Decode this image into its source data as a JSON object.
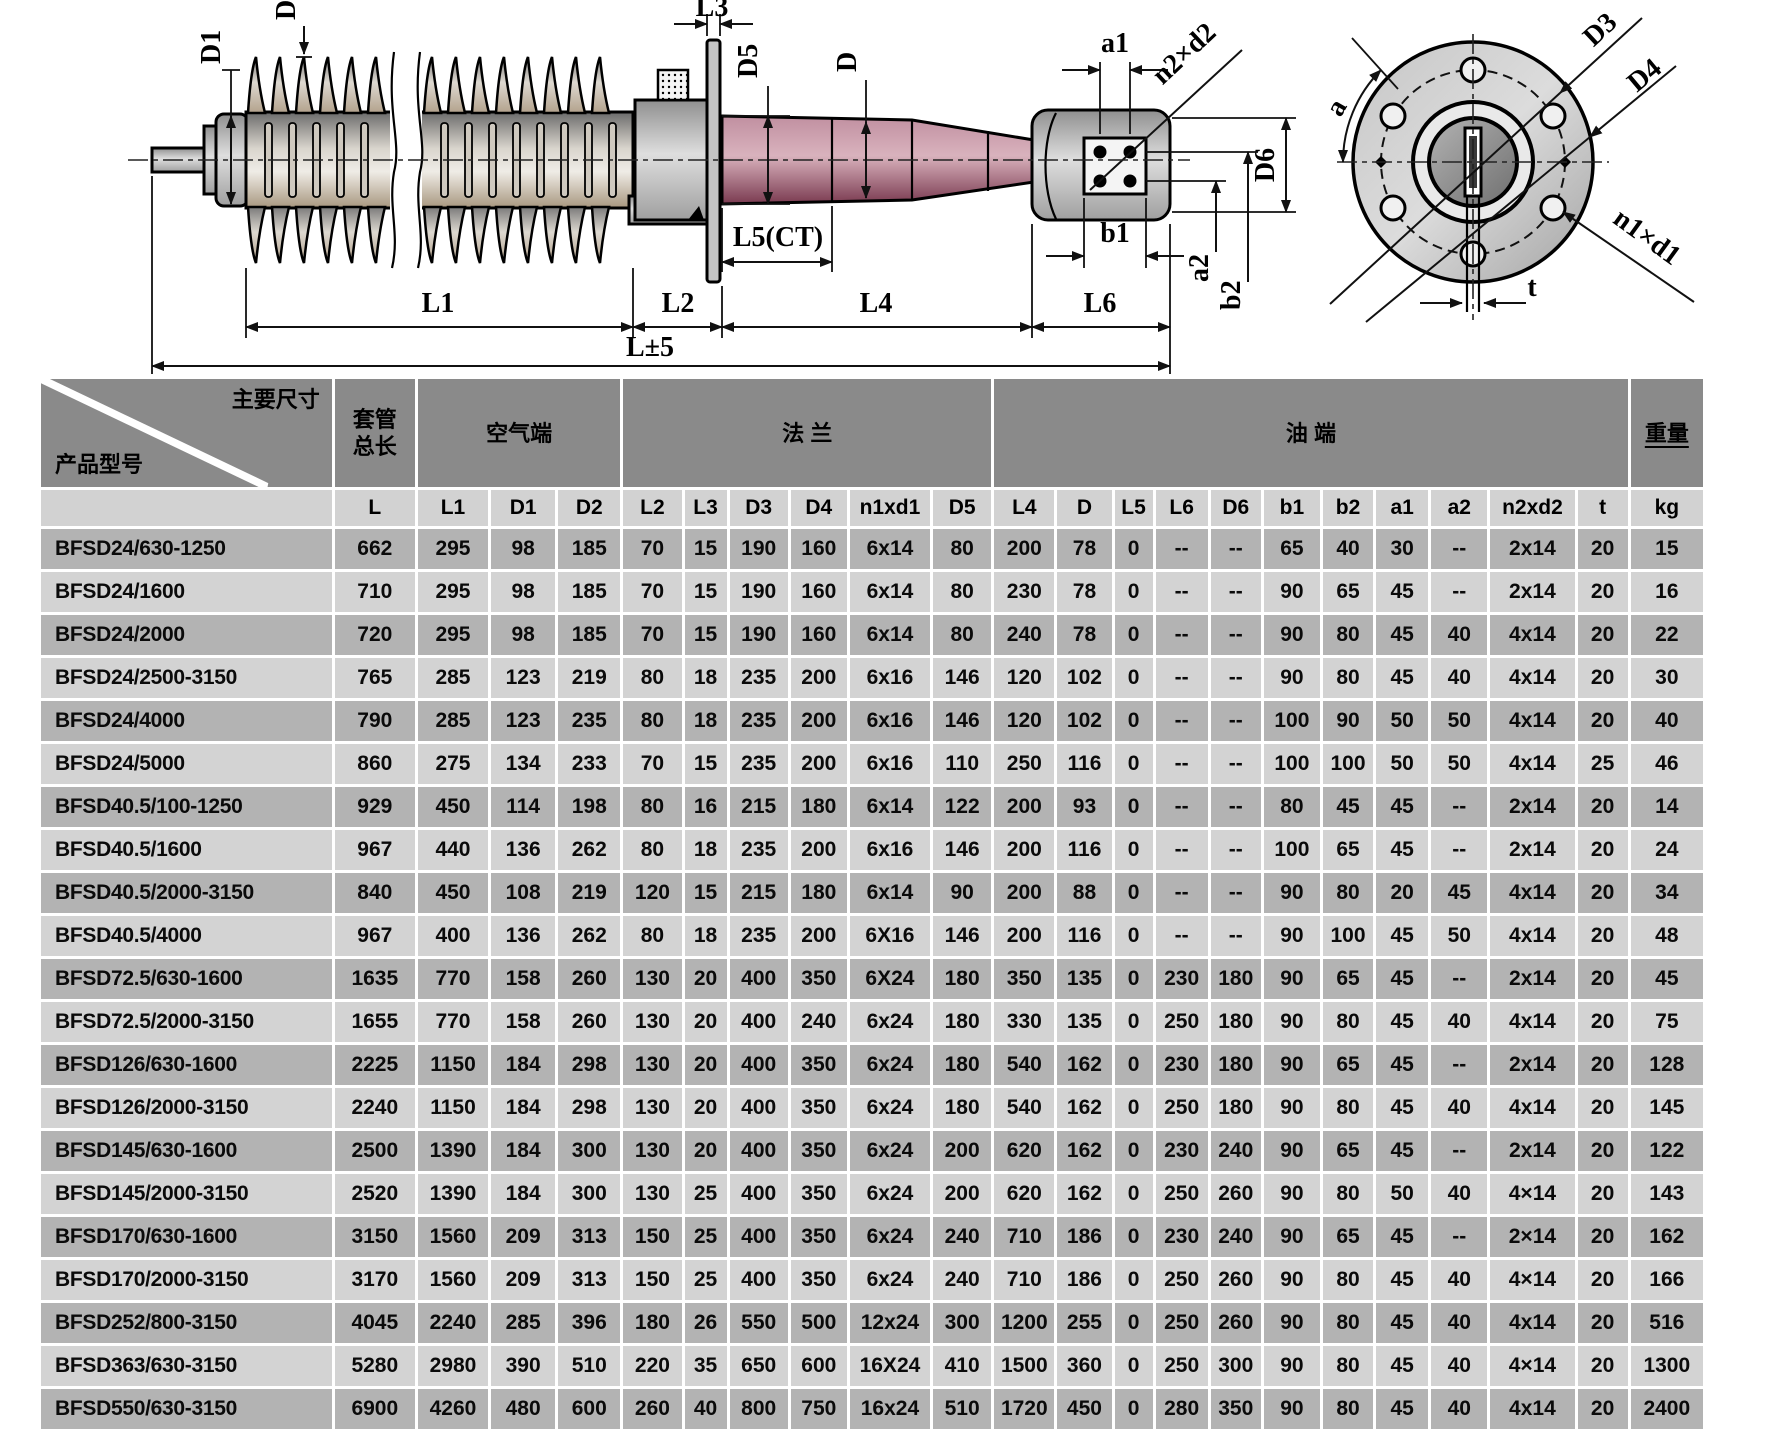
{
  "colors": {
    "header_bg": "#8a8a8a",
    "subheader_bg": "#d2d2d2",
    "row_dark": "#b3b3b3",
    "row_light": "#d3d3d3",
    "oil_body_pink": "#b5788c",
    "porcelain_gray": "#c9c2b6",
    "steel_gray": "#bfbfbf"
  },
  "drawing": {
    "labels": {
      "d1": "D1",
      "d2": "D2",
      "l3": "L3",
      "d5": "D5",
      "d": "D",
      "a1": "a1",
      "n2xd2": "n2×d2",
      "b1": "b1",
      "a2": "a2",
      "b2": "b2",
      "d6": "D6",
      "l1": "L1",
      "l2": "L2",
      "l4": "L4",
      "l5": "L5(CT)",
      "l6": "L6",
      "l_total": "L±5",
      "d3": "D3",
      "d4": "D4",
      "a": "a",
      "n1xd1": "n1×d1",
      "t": "t"
    }
  },
  "table": {
    "corner": {
      "top_label": "主要尺寸",
      "bottom_label": "产品型号"
    },
    "groups": {
      "total_length": "套管\n总长",
      "air_end": "空气端",
      "flange": "法 兰",
      "oil_end": "油 端",
      "weight": "重量"
    },
    "columns": [
      "L",
      "L1",
      "D1",
      "D2",
      "L2",
      "L3",
      "D3",
      "D4",
      "n1xd1",
      "D5",
      "L4",
      "D",
      "L5",
      "L6",
      "D6",
      "b1",
      "b2",
      "a1",
      "a2",
      "n2xd2",
      "t",
      "kg"
    ],
    "rows": [
      {
        "model": "BFSD24/630-1250",
        "values": [
          "662",
          "295",
          "98",
          "185",
          "70",
          "15",
          "190",
          "160",
          "6x14",
          "80",
          "200",
          "78",
          "0",
          "--",
          "--",
          "65",
          "40",
          "30",
          "--",
          "2x14",
          "20",
          "15"
        ]
      },
      {
        "model": "BFSD24/1600",
        "values": [
          "710",
          "295",
          "98",
          "185",
          "70",
          "15",
          "190",
          "160",
          "6x14",
          "80",
          "230",
          "78",
          "0",
          "--",
          "--",
          "90",
          "65",
          "45",
          "--",
          "2x14",
          "20",
          "16"
        ]
      },
      {
        "model": "BFSD24/2000",
        "values": [
          "720",
          "295",
          "98",
          "185",
          "70",
          "15",
          "190",
          "160",
          "6x14",
          "80",
          "240",
          "78",
          "0",
          "--",
          "--",
          "90",
          "80",
          "45",
          "40",
          "4x14",
          "20",
          "22"
        ]
      },
      {
        "model": "BFSD24/2500-3150",
        "values": [
          "765",
          "285",
          "123",
          "219",
          "80",
          "18",
          "235",
          "200",
          "6x16",
          "146",
          "120",
          "102",
          "0",
          "--",
          "--",
          "90",
          "80",
          "45",
          "40",
          "4x14",
          "20",
          "30"
        ]
      },
      {
        "model": "BFSD24/4000",
        "values": [
          "790",
          "285",
          "123",
          "235",
          "80",
          "18",
          "235",
          "200",
          "6x16",
          "146",
          "120",
          "102",
          "0",
          "--",
          "--",
          "100",
          "90",
          "50",
          "50",
          "4x14",
          "20",
          "40"
        ]
      },
      {
        "model": "BFSD24/5000",
        "values": [
          "860",
          "275",
          "134",
          "233",
          "70",
          "15",
          "235",
          "200",
          "6x16",
          "110",
          "250",
          "116",
          "0",
          "--",
          "--",
          "100",
          "100",
          "50",
          "50",
          "4x14",
          "25",
          "46"
        ]
      },
      {
        "model": "BFSD40.5/100-1250",
        "values": [
          "929",
          "450",
          "114",
          "198",
          "80",
          "16",
          "215",
          "180",
          "6x14",
          "122",
          "200",
          "93",
          "0",
          "--",
          "--",
          "80",
          "45",
          "45",
          "--",
          "2x14",
          "20",
          "14"
        ]
      },
      {
        "model": "BFSD40.5/1600",
        "values": [
          "967",
          "440",
          "136",
          "262",
          "80",
          "18",
          "235",
          "200",
          "6x16",
          "146",
          "200",
          "116",
          "0",
          "--",
          "--",
          "100",
          "65",
          "45",
          "--",
          "2x14",
          "20",
          "24"
        ]
      },
      {
        "model": "BFSD40.5/2000-3150",
        "values": [
          "840",
          "450",
          "108",
          "219",
          "120",
          "15",
          "215",
          "180",
          "6x14",
          "90",
          "200",
          "88",
          "0",
          "--",
          "--",
          "90",
          "80",
          "20",
          "45",
          "4x14",
          "20",
          "34"
        ]
      },
      {
        "model": "BFSD40.5/4000",
        "values": [
          "967",
          "400",
          "136",
          "262",
          "80",
          "18",
          "235",
          "200",
          "6X16",
          "146",
          "200",
          "116",
          "0",
          "--",
          "--",
          "90",
          "100",
          "45",
          "50",
          "4x14",
          "20",
          "48"
        ]
      },
      {
        "model": "BFSD72.5/630-1600",
        "values": [
          "1635",
          "770",
          "158",
          "260",
          "130",
          "20",
          "400",
          "350",
          "6X24",
          "180",
          "350",
          "135",
          "0",
          "230",
          "180",
          "90",
          "65",
          "45",
          "--",
          "2x14",
          "20",
          "45"
        ]
      },
      {
        "model": "BFSD72.5/2000-3150",
        "values": [
          "1655",
          "770",
          "158",
          "260",
          "130",
          "20",
          "400",
          "240",
          "6x24",
          "180",
          "330",
          "135",
          "0",
          "250",
          "180",
          "90",
          "80",
          "45",
          "40",
          "4x14",
          "20",
          "75"
        ]
      },
      {
        "model": "BFSD126/630-1600",
        "values": [
          "2225",
          "1150",
          "184",
          "298",
          "130",
          "20",
          "400",
          "350",
          "6x24",
          "180",
          "540",
          "162",
          "0",
          "230",
          "180",
          "90",
          "65",
          "45",
          "--",
          "2x14",
          "20",
          "128"
        ]
      },
      {
        "model": "BFSD126/2000-3150",
        "values": [
          "2240",
          "1150",
          "184",
          "298",
          "130",
          "20",
          "400",
          "350",
          "6x24",
          "180",
          "540",
          "162",
          "0",
          "250",
          "180",
          "90",
          "80",
          "45",
          "40",
          "4x14",
          "20",
          "145"
        ]
      },
      {
        "model": "BFSD145/630-1600",
        "values": [
          "2500",
          "1390",
          "184",
          "300",
          "130",
          "20",
          "400",
          "350",
          "6x24",
          "200",
          "620",
          "162",
          "0",
          "230",
          "240",
          "90",
          "65",
          "45",
          "--",
          "2x14",
          "20",
          "122"
        ]
      },
      {
        "model": "BFSD145/2000-3150",
        "values": [
          "2520",
          "1390",
          "184",
          "300",
          "130",
          "25",
          "400",
          "350",
          "6x24",
          "200",
          "620",
          "162",
          "0",
          "250",
          "260",
          "90",
          "80",
          "50",
          "40",
          "4×14",
          "20",
          "143"
        ]
      },
      {
        "model": "BFSD170/630-1600",
        "values": [
          "3150",
          "1560",
          "209",
          "313",
          "150",
          "25",
          "400",
          "350",
          "6x24",
          "240",
          "710",
          "186",
          "0",
          "230",
          "240",
          "90",
          "65",
          "45",
          "--",
          "2×14",
          "20",
          "162"
        ]
      },
      {
        "model": "BFSD170/2000-3150",
        "values": [
          "3170",
          "1560",
          "209",
          "313",
          "150",
          "25",
          "400",
          "350",
          "6x24",
          "240",
          "710",
          "186",
          "0",
          "250",
          "260",
          "90",
          "80",
          "45",
          "40",
          "4×14",
          "20",
          "166"
        ]
      },
      {
        "model": "BFSD252/800-3150",
        "values": [
          "4045",
          "2240",
          "285",
          "396",
          "180",
          "26",
          "550",
          "500",
          "12x24",
          "300",
          "1200",
          "255",
          "0",
          "250",
          "260",
          "90",
          "80",
          "45",
          "40",
          "4x14",
          "20",
          "516"
        ]
      },
      {
        "model": "BFSD363/630-3150",
        "values": [
          "5280",
          "2980",
          "390",
          "510",
          "220",
          "35",
          "650",
          "600",
          "16X24",
          "410",
          "1500",
          "360",
          "0",
          "250",
          "300",
          "90",
          "80",
          "45",
          "40",
          "4×14",
          "20",
          "1300"
        ]
      },
      {
        "model": "BFSD550/630-3150",
        "values": [
          "6900",
          "4260",
          "480",
          "600",
          "260",
          "40",
          "800",
          "750",
          "16x24",
          "510",
          "1720",
          "450",
          "0",
          "280",
          "350",
          "90",
          "80",
          "45",
          "40",
          "4x14",
          "20",
          "2400"
        ]
      }
    ]
  }
}
